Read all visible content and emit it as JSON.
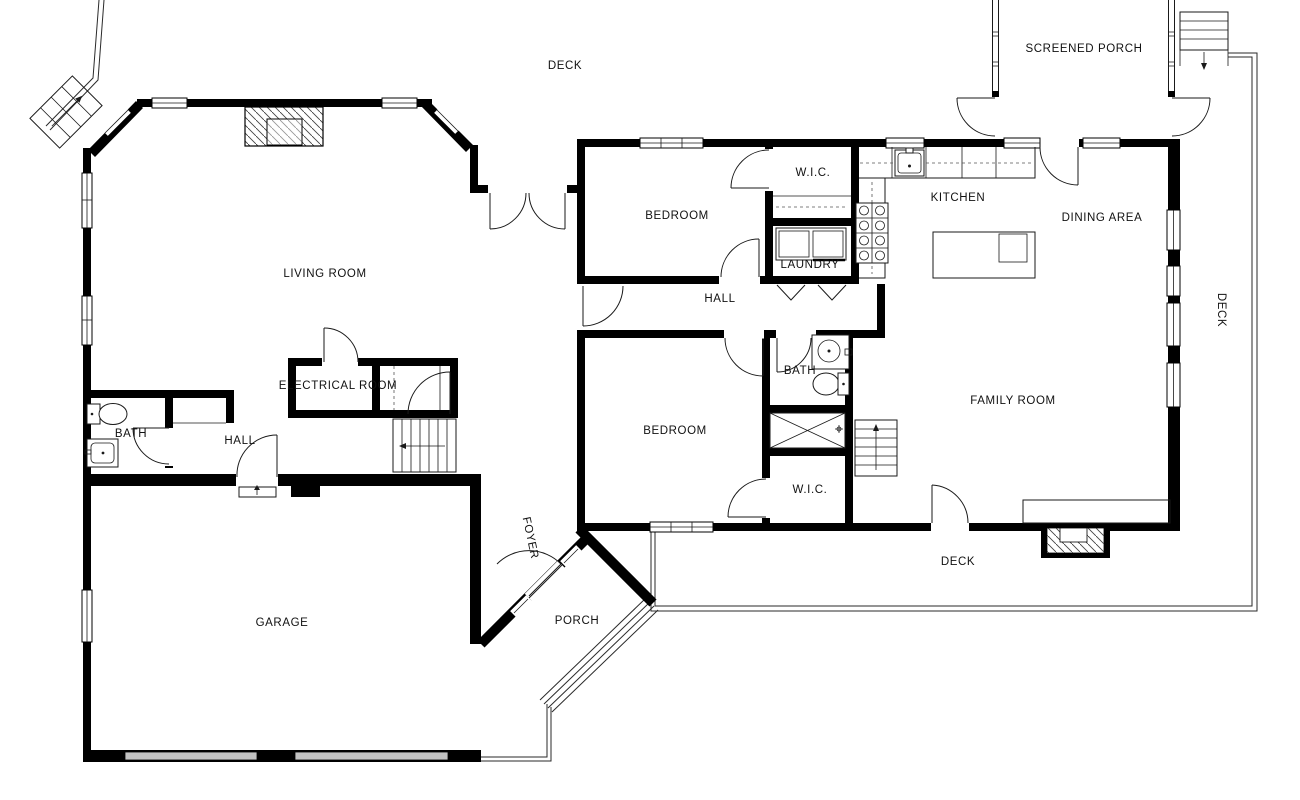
{
  "floor_plan": {
    "labels": {
      "deck_top": "DECK",
      "screened_porch": "SCREENED PORCH",
      "bedroom1": "BEDROOM",
      "wic1": "W.I.C.",
      "kitchen": "KITCHEN",
      "dining": "DINING AREA",
      "laundry": "LAUNDRY",
      "hall_center": "HALL",
      "living_room": "LIVING ROOM",
      "electrical_room": "ELECTRICAL ROOM",
      "bath_left": "BATH",
      "hall_left": "HALL",
      "bedroom2": "BEDROOM",
      "bath_center": "BATH",
      "family_room": "FAMILY ROOM",
      "wic2": "W.I.C.",
      "deck_right": "DECK",
      "deck_bottom": "DECK",
      "garage": "GARAGE",
      "foyer": "FOYER",
      "porch": "PORCH"
    },
    "colors": {
      "walls": "#000000",
      "background": "#ffffff",
      "garage_door": "#c2c2c2",
      "text": "#111111"
    }
  }
}
